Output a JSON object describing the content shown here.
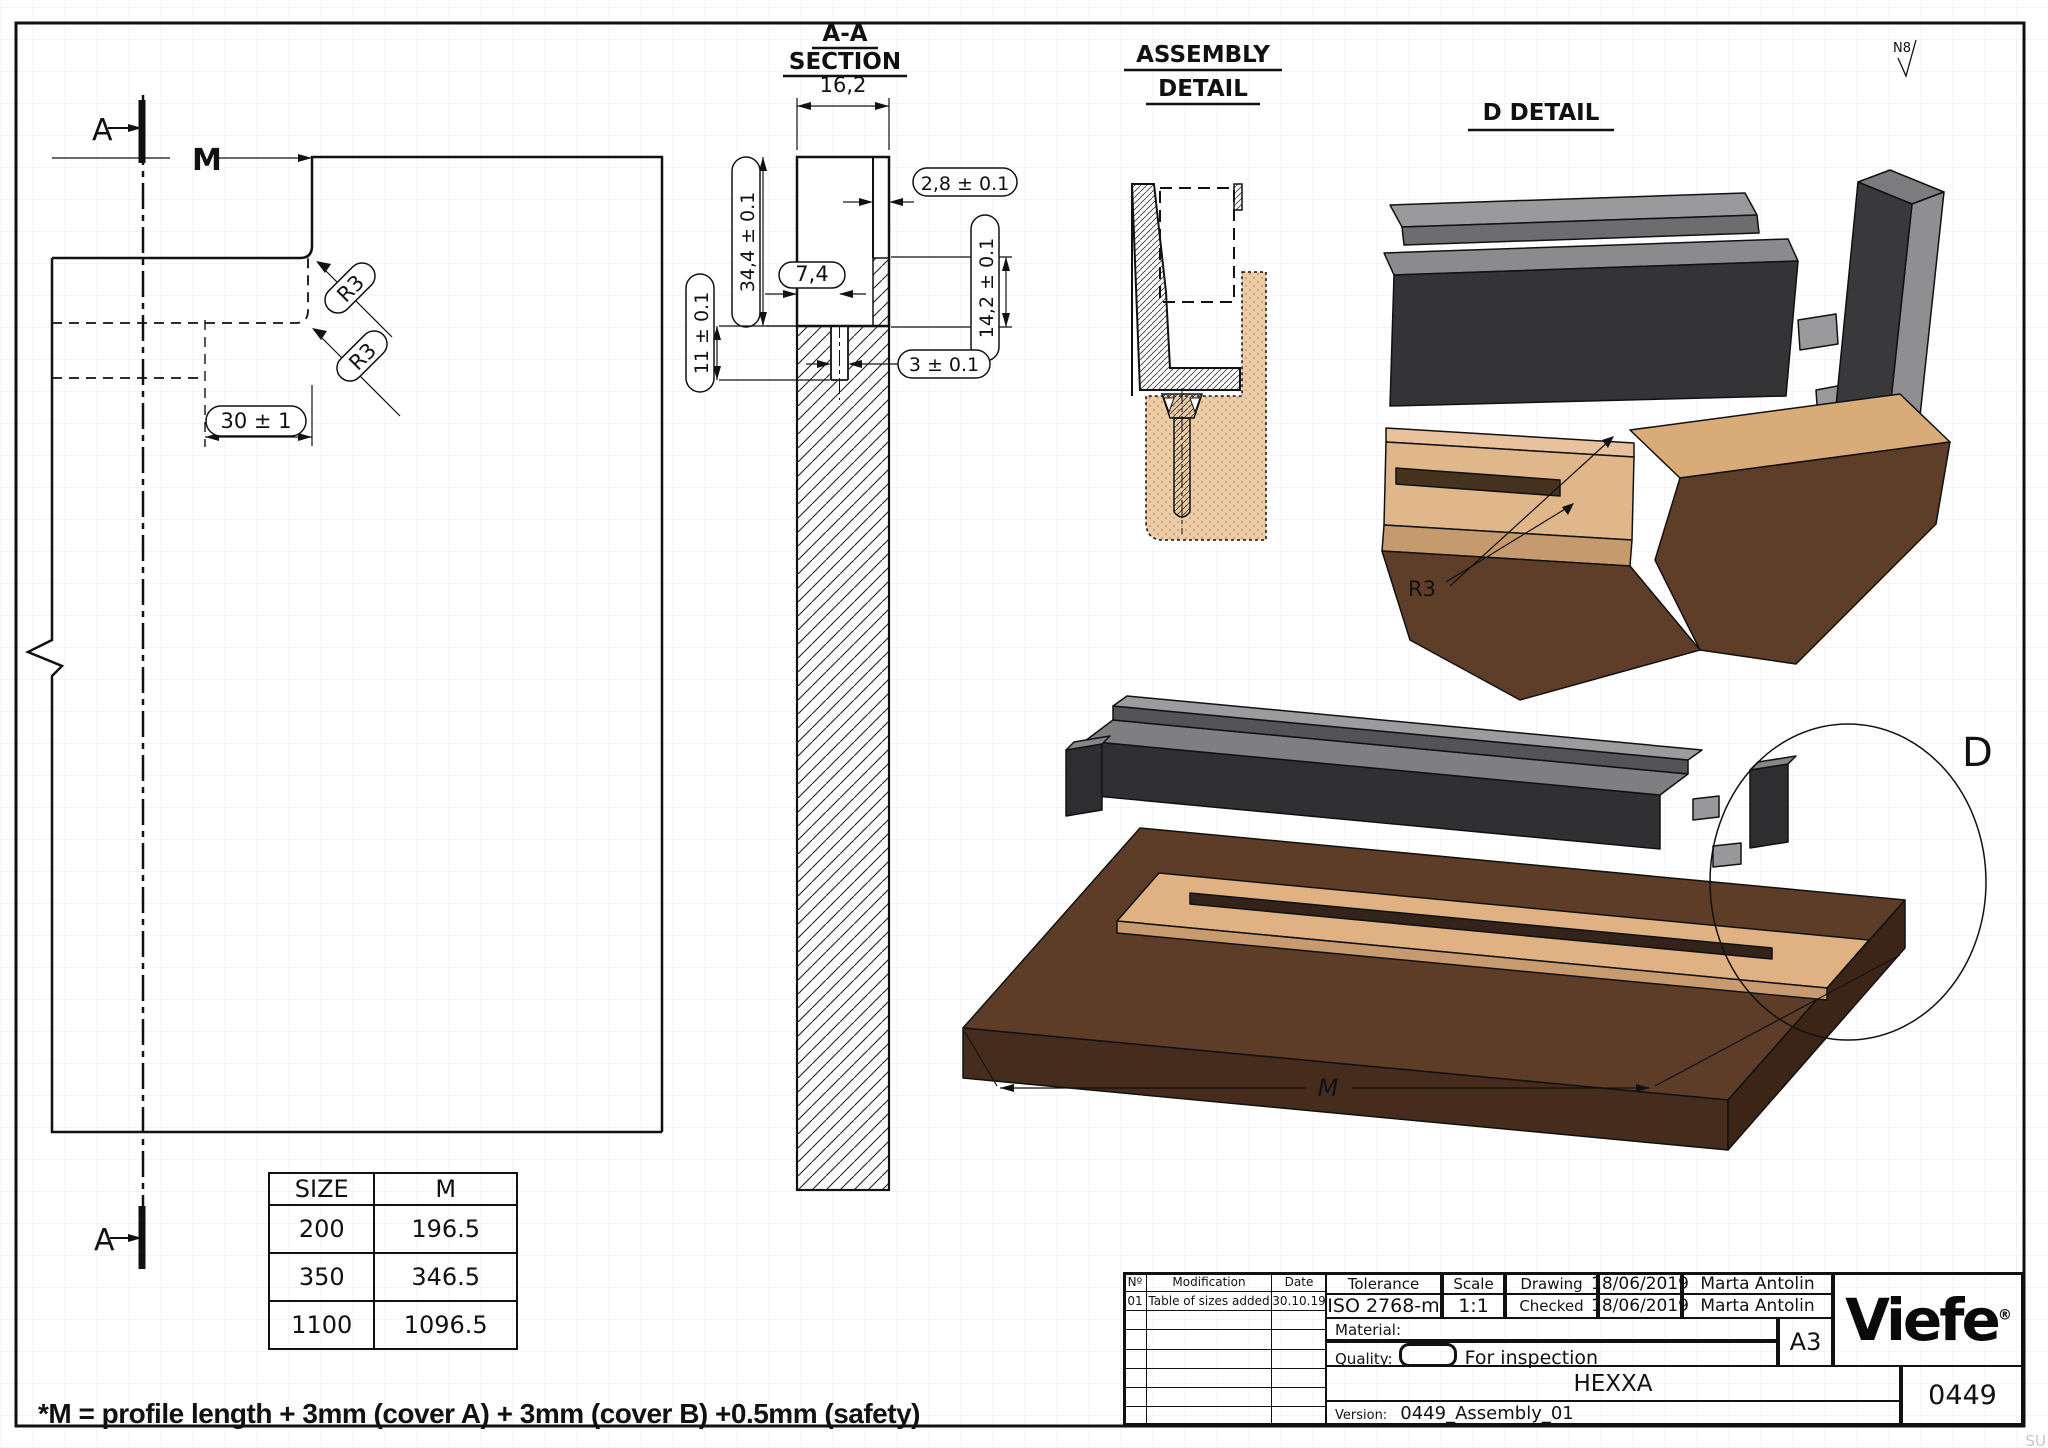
{
  "drawing": {
    "footnote": "*M = profile length + 3mm (cover A) + 3mm (cover B) +0.5mm (safety)",
    "surface_finish": "N8",
    "watermark": "SU"
  },
  "side_view": {
    "section_label_top": "A",
    "section_label_bottom": "A",
    "length_label": "M",
    "radius_label_1": "R3",
    "radius_label_2": "R3",
    "offset_dim": "30 ± 1"
  },
  "section_aa": {
    "title_line1": "A-A",
    "title_line2": "SECTION",
    "dim_width": "16,2",
    "dim_wall": "2,8 ± 0.1",
    "dim_height": "34,4 ± 0.1",
    "dim_slot_offset": "7,4",
    "dim_step": "14,2 ± 0.1",
    "dim_slot_depth": "11 ± 0.1",
    "dim_slot_width": "3 ± 0.1"
  },
  "assembly_detail": {
    "title_line1": "ASSEMBLY",
    "title_line2": "DETAIL"
  },
  "d_detail": {
    "title": "D DETAIL",
    "radius_label": "R3"
  },
  "assembly_3d": {
    "detail_label": "D",
    "length_label": "M"
  },
  "size_table": {
    "headers": [
      "SIZE",
      "M"
    ],
    "rows": [
      [
        "200",
        "196.5"
      ],
      [
        "350",
        "346.5"
      ],
      [
        "1100",
        "1096.5"
      ]
    ]
  },
  "title_block": {
    "rev_col_no": "Nº",
    "rev_col_mod": "Modification",
    "rev_col_date": "Date",
    "rev_row_no": "01",
    "rev_row_mod": "Table of sizes added",
    "rev_row_date": "30.10.19",
    "tolerance_label": "Tolerance",
    "tolerance_value": "ISO 2768-m",
    "scale_label": "Scale",
    "scale_value": "1:1",
    "drawing_label": "Drawing",
    "drawing_date": "18/06/2019",
    "drawing_by": "Marta Antolin",
    "checked_label": "Checked",
    "checked_date": "18/06/2019",
    "checked_by": "Marta Antolin",
    "material_label": "Material:",
    "quality_label": "Quality:",
    "quality_value": "For inspection",
    "paper_size": "A3",
    "product_name": "HEXXA",
    "version_label": "Version:",
    "version_value": "0449_Assembly_01",
    "drawing_number": "0449",
    "brand": "Viefe",
    "brand_reg": "®"
  },
  "colors": {
    "wood_dark": "#5d3d28",
    "wood_light": "#e0b183",
    "profile_dark": "#303032",
    "profile_gray": "#7f7f82"
  }
}
